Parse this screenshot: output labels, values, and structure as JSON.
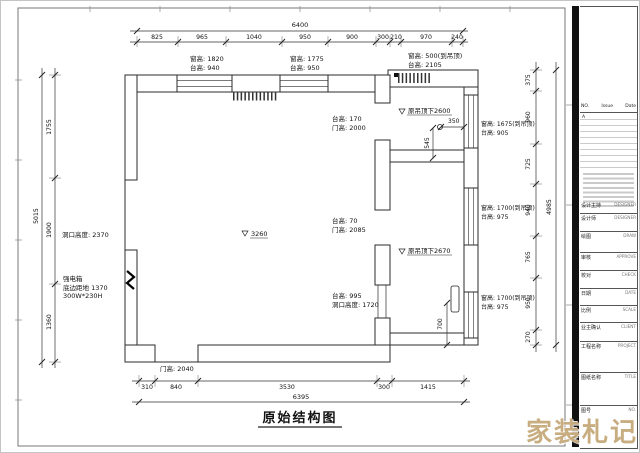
{
  "page": {
    "title": "原始结构图",
    "watermark": "家装札记"
  },
  "dims": {
    "top": {
      "total": "6400",
      "segs": [
        "825",
        "965",
        "1040",
        "950",
        "900",
        "300",
        "210",
        "970",
        "240"
      ]
    },
    "bottom": {
      "total": "6395",
      "segs": [
        "310",
        "840",
        "3530",
        "300",
        "1415"
      ]
    },
    "left": {
      "total": "5015",
      "segs": [
        "1755",
        "1900",
        "1360"
      ]
    },
    "right": {
      "total": "4985",
      "segs": [
        "375",
        "960",
        "725",
        "940",
        "765",
        "950",
        "270"
      ]
    },
    "d350": "350",
    "d545": "545",
    "d700": "700"
  },
  "annotations": {
    "win_top_left_h": "窗高: 1820",
    "win_top_left_s": "台高: 940",
    "win_top_mid_h": "窗高: 1775",
    "win_top_mid_s": "台高: 950",
    "win_top_right_h": "窗高: 500(到吊顶)",
    "win_top_right_s": "台高: 2105",
    "opening1_s": "台高: 170",
    "opening1_h": "门高: 2000",
    "opening2_s": "台高: 70",
    "opening2_h": "门高: 2085",
    "opening3_s": "台高: 995",
    "opening3_h": "洞口高度: 1720",
    "ceiling_main": "3260",
    "ceiling_tr": "原吊顶下2600",
    "ceiling_br": "原吊顶下2670",
    "left_opening": "洞口高度: 2370",
    "ebox1": "强电箱",
    "ebox2": "底边距地 1370",
    "ebox3": "300W*230H",
    "door_bottom": "门高: 2040",
    "win_r1_h": "窗高: 1675(到吊顶)",
    "win_r1_s": "台高: 905",
    "win_r2_h": "窗高: 1700(到吊顶)",
    "win_r2_s": "台高: 975",
    "win_r3_h": "窗高: 1700(到吊顶)",
    "win_r3_s": "台高: 975"
  },
  "titleblock": {
    "no": "NO.",
    "issue": "Issue",
    "date": "Date",
    "rev": "A",
    "rows": [
      {
        "cn": "设计主持",
        "en": "DESIGNER"
      },
      {
        "cn": "设计师",
        "en": "DESIGNER"
      },
      {
        "cn": "绘图",
        "en": "DRAW"
      },
      {
        "cn": "审核",
        "en": "APPROVE"
      },
      {
        "cn": "校对",
        "en": "CHECK"
      },
      {
        "cn": "日期",
        "en": "DATE"
      },
      {
        "cn": "比例",
        "en": "SCALE"
      },
      {
        "cn": "业主确认",
        "en": "CLIENT"
      },
      {
        "cn": "工程名称",
        "en": "PROJECT"
      },
      {
        "cn": "图纸名称",
        "en": "TITLE"
      },
      {
        "cn": "图号",
        "en": "NO."
      }
    ]
  }
}
